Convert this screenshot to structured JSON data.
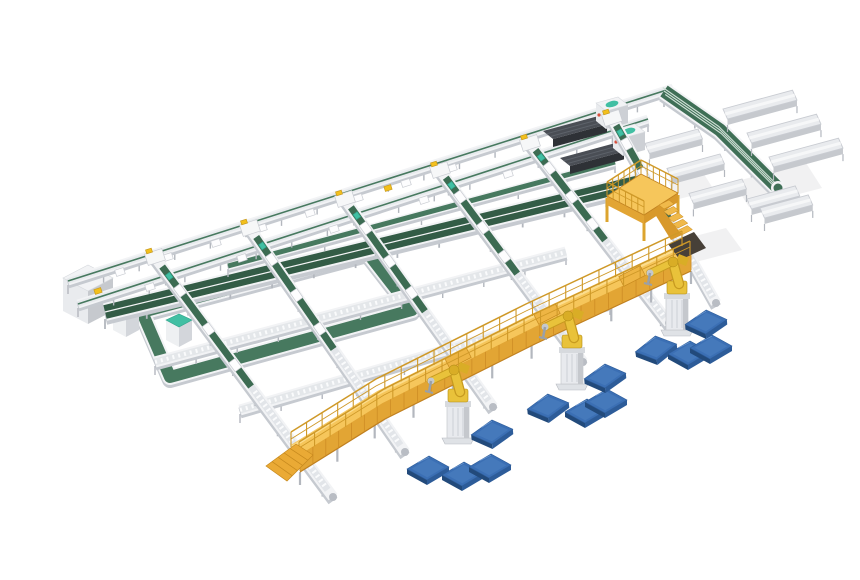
{
  "palette": {
    "background": "#ffffff",
    "belt_green": "#47795f",
    "belt_green_dark": "#3c6b52",
    "belt_green_deep": "#335c46",
    "teal_accent": "#41bfa3",
    "frame_white": "#f2f3f5",
    "frame_gray": "#c9ccd2",
    "shadow_gray": "#c6cad0",
    "leg_gray": "#b3b7be",
    "roller_light": "#e2e5e9",
    "roller_stripe": "#fafbfc",
    "deck_yellow": "#f6c65b",
    "deck_highlight": "#fcdd8d",
    "deck_side": "#e2a534",
    "deck_dark": "#c08020",
    "rail_yellow": "#cf9928",
    "robot_yellow": "#e9c23a",
    "robot_shade": "#c79a1f",
    "pedestal_light": "#e8eaee",
    "pedestal_gray": "#c5c8cd",
    "pallet_blue_top": "#3b6fb4",
    "pallet_blue_inner": "#4579bb",
    "pallet_blue_side": "#224a7b",
    "pallet_blue_edge": "#2d5c99",
    "machine_dark_top": "#4a4e55",
    "machine_dark_side": "#2e3136",
    "machine_stripe": "#5d626a",
    "cube_top": "#f2f3f5",
    "cube_front": "#e9ebee",
    "cube_side": "#c6c9ce",
    "floor_shadow": "#ededef",
    "red_dot": "#d9503e"
  },
  "scene": {
    "shadows": [
      [
        [
          667,
          180
        ],
        [
          702,
          171
        ],
        [
          714,
          190
        ],
        [
          679,
          199
        ]
      ],
      [
        [
          676,
          241
        ],
        [
          726,
          228
        ],
        [
          742,
          250
        ],
        [
          692,
          263
        ]
      ],
      [
        [
          733,
          182
        ],
        [
          806,
          163
        ],
        [
          822,
          188
        ],
        [
          749,
          207
        ]
      ]
    ],
    "cube": {
      "top": [
        [
          63,
          278
        ],
        [
          88,
          265
        ],
        [
          113,
          278
        ],
        [
          88,
          291
        ]
      ],
      "front": [
        [
          63,
          278
        ],
        [
          63,
          311
        ],
        [
          88,
          324
        ],
        [
          88,
          291
        ]
      ],
      "side": [
        [
          88,
          291
        ],
        [
          88,
          324
        ],
        [
          113,
          311
        ],
        [
          113,
          278
        ]
      ]
    },
    "loop": {
      "corners": [
        [
          142,
          312
        ],
        [
          367,
          252
        ],
        [
          412,
          310
        ],
        [
          170,
          377
        ]
      ]
    },
    "cabinets": [
      [
        113,
        304
      ],
      [
        166,
        314
      ]
    ],
    "cross_rollers": [
      {
        "pts": [
          [
            155,
            362
          ],
          [
            566,
            252
          ]
        ]
      },
      {
        "pts": [
          [
            240,
            410
          ],
          [
            610,
            302
          ]
        ]
      }
    ],
    "band": {
      "from": [
        105,
        312
      ],
      "to": [
        648,
        180
      ]
    },
    "cross_upper": {
      "from": [
        228,
        266
      ],
      "to": [
        615,
        162
      ]
    },
    "trunks": [
      {
        "from": [
          68,
          281
        ],
        "to": [
          673,
          88
        ]
      },
      {
        "from": [
          78,
          304
        ],
        "to": [
          648,
          119
        ]
      }
    ],
    "trunk_carriages": [
      [
        120,
        272
      ],
      [
        168,
        257
      ],
      [
        216,
        243
      ],
      [
        262,
        228
      ],
      [
        310,
        213
      ],
      [
        358,
        198
      ],
      [
        406,
        183
      ],
      [
        452,
        168
      ],
      [
        150,
        287
      ],
      [
        242,
        258
      ],
      [
        334,
        229
      ],
      [
        424,
        200
      ],
      [
        508,
        174
      ]
    ],
    "trunk_marks": [
      [
        152,
        261
      ],
      [
        388,
        188
      ],
      [
        98,
        291
      ]
    ],
    "machines": [
      {
        "from": [
          543,
          131
        ],
        "head": [
          596,
          103
        ]
      },
      {
        "from": [
          560,
          158
        ],
        "head": [
          613,
          130
        ]
      }
    ],
    "spur": {
      "path": [
        [
          664,
          91
        ],
        [
          720,
          130
        ],
        [
          778,
          188
        ]
      ]
    },
    "chutes_ne": [
      [
        717,
        112
      ],
      [
        741,
        136
      ],
      [
        763,
        160
      ]
    ],
    "chutes_sw": [
      [
        704,
        126
      ],
      [
        726,
        151
      ],
      [
        748,
        176
      ]
    ],
    "end_troughs": [
      [
        747,
        199
      ],
      [
        760,
        208
      ]
    ],
    "lanes": [
      {
        "s": [
          155,
          257
        ],
        "e": [
          333,
          497
        ]
      },
      {
        "s": [
          250,
          228
        ],
        "e": [
          405,
          452
        ]
      },
      {
        "s": [
          345,
          199
        ],
        "e": [
          493,
          407
        ]
      },
      {
        "s": [
          440,
          170
        ],
        "e": [
          583,
          362
        ]
      },
      {
        "s": [
          530,
          143
        ],
        "e": [
          669,
          323
        ]
      },
      {
        "s": [
          612,
          118
        ],
        "e": [
          716,
          303
        ]
      }
    ],
    "mezzanine": {
      "deck": [
        [
          607,
          196
        ],
        [
          641,
          174
        ],
        [
          678,
          193
        ],
        [
          644,
          215
        ]
      ],
      "leg_drop": 26,
      "stair_from": [
        659,
        205
      ]
    },
    "walkway": {
      "path": [
        [
          295,
          450
        ],
        [
          380,
          397
        ],
        [
          530,
          322
        ],
        [
          686,
          249
        ]
      ],
      "bumps": [
        [
          458,
          358
        ],
        [
          547,
          314
        ],
        [
          632,
          276
        ]
      ],
      "dark_ramp": [
        [
          668,
          244
        ],
        [
          694,
          232
        ],
        [
          706,
          248
        ],
        [
          680,
          260
        ]
      ],
      "start_stairs": [
        [
          296,
          444
        ],
        [
          313,
          455
        ],
        [
          287,
          481
        ],
        [
          266,
          466
        ]
      ]
    },
    "robots": [
      [
        458,
        436
      ],
      [
        572,
        382
      ],
      [
        677,
        328
      ]
    ],
    "pallets": [
      [
        428,
        468,
        0
      ],
      [
        463,
        474,
        0
      ],
      [
        490,
        466,
        0
      ],
      [
        492,
        432,
        -5
      ],
      [
        548,
        406,
        -6
      ],
      [
        586,
        411,
        0
      ],
      [
        606,
        401,
        0
      ],
      [
        605,
        376,
        -5
      ],
      [
        656,
        348,
        -8
      ],
      [
        689,
        353,
        0
      ],
      [
        711,
        347,
        0
      ],
      [
        706,
        322,
        -4
      ]
    ]
  }
}
